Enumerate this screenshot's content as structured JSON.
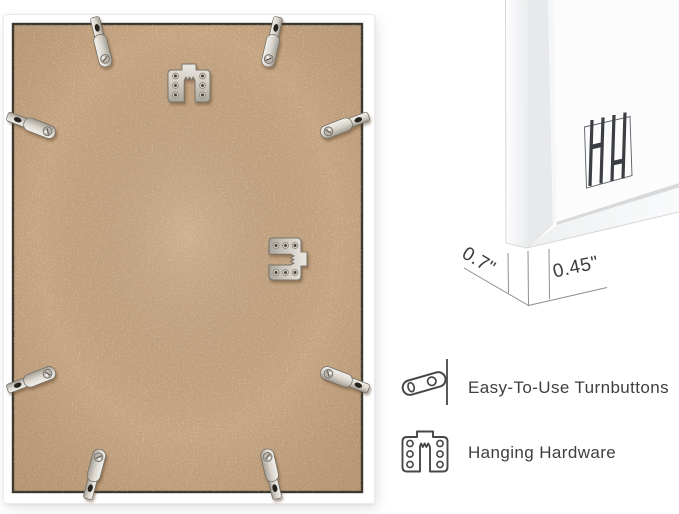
{
  "colors": {
    "background": "#ffffff",
    "frame_white": "#ffffff",
    "mdf_board": "#c5a481",
    "board_edge": "#3a372e",
    "metal_hardware": "#d6d2ca",
    "annotation_text": "#3c3c3c",
    "feature_icon_stroke": "#474747"
  },
  "frame_back": {
    "turnbutton_count": 8,
    "sawtooth_hanger_count": 2
  },
  "corner_detail": {
    "logo_icon": "hh-monogram-logo",
    "dimensions": [
      {
        "label": "0.7\""
      },
      {
        "label": "0.45\""
      }
    ]
  },
  "features": [
    {
      "icon": "turnbutton-icon",
      "label": "Easy-To-Use Turnbuttons"
    },
    {
      "icon": "hanging-hardware-icon",
      "label": "Hanging Hardware"
    }
  ]
}
